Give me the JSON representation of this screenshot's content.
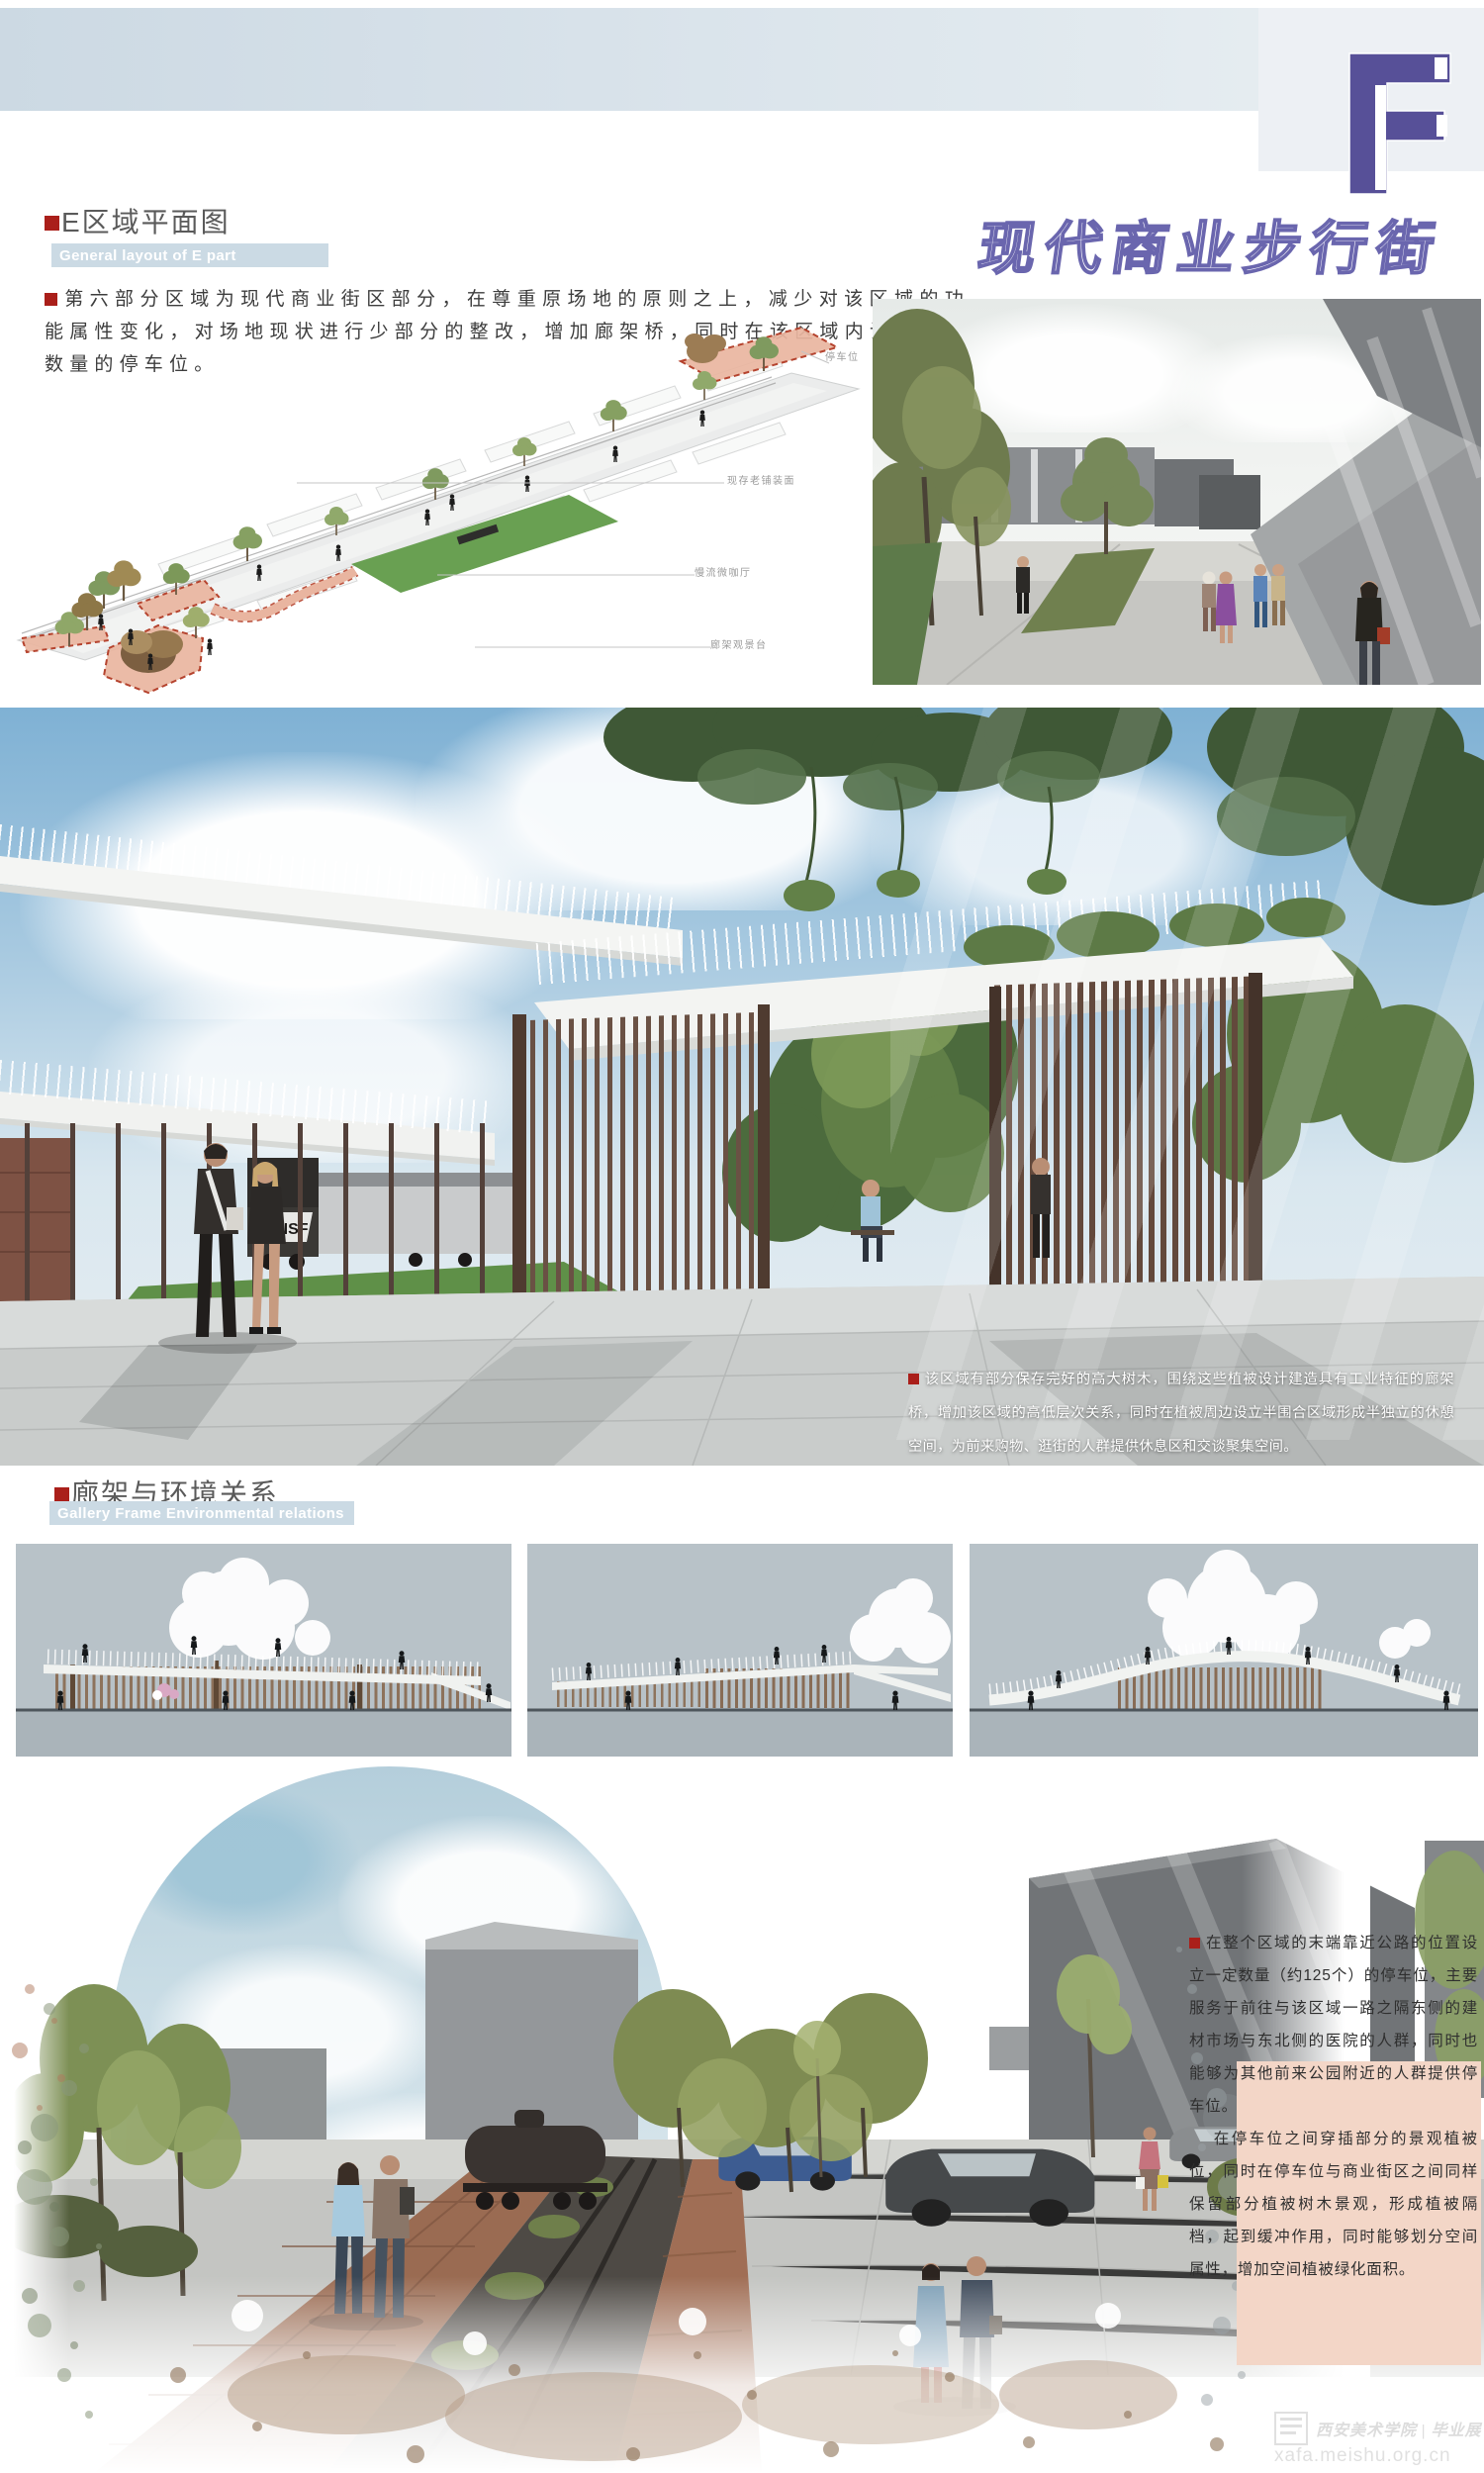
{
  "board": {
    "title_cn": "现代商业步行街",
    "plate_letter": "F"
  },
  "section_e": {
    "title": "E区域平面图",
    "subtitle_en": "General layout of E part",
    "paragraph": "第六部分区域为现代商业街区部分，在尊重原场地的原则之上，减少对该区域的功能属性变化，对场地现状进行少部分的整改，增加廊架桥，同时在该区域内设立一定数量的停车位。"
  },
  "plan": {
    "labels": [
      {
        "text": "停车位"
      },
      {
        "text": "现存老铺装面"
      },
      {
        "text": "慢流微咖厅"
      },
      {
        "text": "廊架观景台"
      }
    ]
  },
  "central_render": {
    "caption": "该区域有部分保存完好的高大树木，围绕这些植被设计建造具有工业特征的廊架桥，增加该区域的高低层次关系，同时在植被周边设立半围合区域形成半独立的休憩空间，为前来购物、逛街的人群提供休息区和交谈聚集空间。"
  },
  "section_gallery": {
    "title": "廊架与环境关系",
    "subtitle_en": "Gallery Frame Environmental relations"
  },
  "parking_text": {
    "para1": "在整个区域的末端靠近公路的位置设立一定数量（约125个）的停车位，主要服务于前往与该区域一路之隔东侧的建材市场与东北侧的医院的人群，同时也能够为其他前来公园附近的人群提供停车位。",
    "para2": "在停车位之间穿插部分的景观植被位，同时在停车位与商业街区之间同样保留部分植被树木景观，形成植被隔档，起到缓冲作用，同时能够划分空间属性，增加空间植被绿化面积。"
  },
  "watermark": {
    "line_cn": "西安美术学院 | 毕业展",
    "url": "xafa.meishu.org.cn"
  },
  "colors": {
    "accent_purple": "#575098",
    "title_outline": "#6a66ae",
    "bullet_red": "#aa1f1a",
    "en_bar_blue": "#cbdae4",
    "salmon_zone": "#e9b5a0",
    "panel_pink": "#f3d6c7"
  }
}
